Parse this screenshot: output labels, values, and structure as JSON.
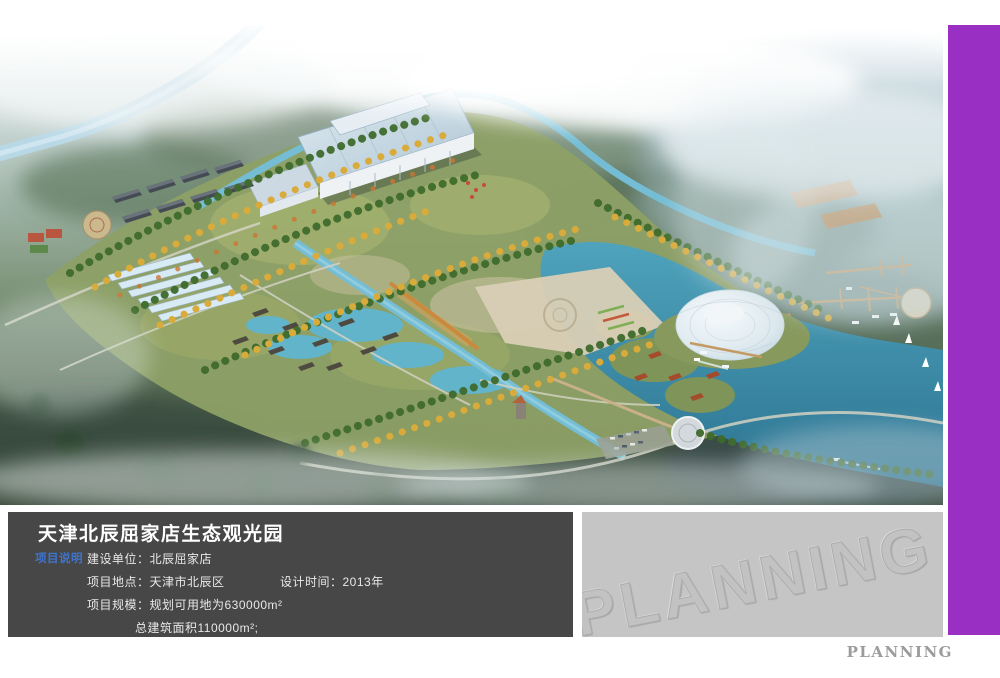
{
  "board": {
    "watermark": "PLANNING",
    "footer_brand": "PLANNING",
    "colors": {
      "accent_purple": "#9a2fc4",
      "info_panel_bg": "#474747",
      "watermark_panel_bg": "#c5c5c5",
      "section_tag_blue": "#3f74cc"
    }
  },
  "info_panel": {
    "title": "天津北辰屈家店生态观光园",
    "section_tag": "项目说明",
    "fields": {
      "builder": "建设单位：北辰屈家店",
      "location": "项目地点：天津市北辰区",
      "design_time": "设计时间：2013年",
      "scale": "项目规模：规划可用地为630000m²",
      "floor_area": "总建筑面积110000m²;"
    }
  }
}
